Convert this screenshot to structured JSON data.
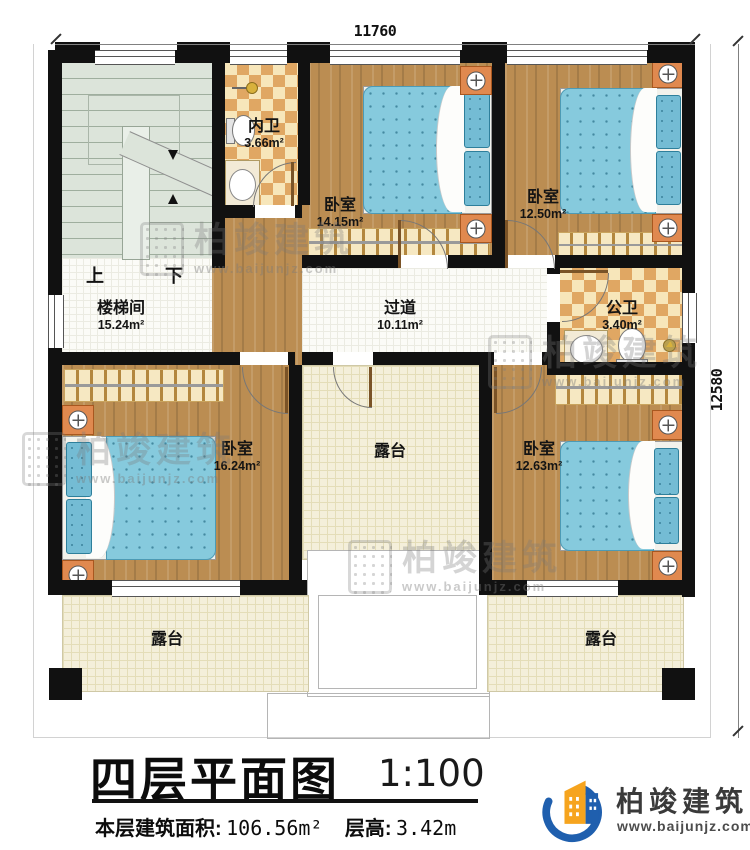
{
  "dimensions": {
    "top": "11760",
    "right": "12580"
  },
  "stairs": {
    "up": "上",
    "down": "下"
  },
  "rooms": [
    {
      "name": "楼梯间",
      "area": "15.24m²"
    },
    {
      "name": "内卫",
      "area": "3.66m²"
    },
    {
      "name": "卧室",
      "area": "14.15m²"
    },
    {
      "name": "卧室",
      "area": "12.50m²"
    },
    {
      "name": "过道",
      "area": "10.11m²"
    },
    {
      "name": "公卫",
      "area": "3.40m²"
    },
    {
      "name": "卧室",
      "area": "16.24m²"
    },
    {
      "name": "露台",
      "area": ""
    },
    {
      "name": "卧室",
      "area": "12.63m²"
    },
    {
      "name": "露台",
      "area": ""
    },
    {
      "name": "露台",
      "area": ""
    }
  ],
  "title": {
    "text": "四层平面图",
    "scale": "1:100"
  },
  "info": {
    "area_label": "本层建筑面积:",
    "area_value": "106.56m²",
    "height_label": "层高:",
    "height_value": "3.42m"
  },
  "logo": {
    "name": "柏竣建筑",
    "url": "www.baijunjz.com"
  },
  "watermark": {
    "name": "柏竣建筑",
    "url": "www.baijunjz.com"
  },
  "colors": {
    "wall": "#111111",
    "wood": "#bb8d52",
    "bed": "#86cadd",
    "pillow": "#74bcd4",
    "checker_dark": "#e0a763",
    "checker_light": "#f7e6ba",
    "terrace": "#f4efda",
    "stair": "#dce4da",
    "nightstand": "#e0894f",
    "wardrobe": "#f6e8c2",
    "logo_blue": "#1f5fae",
    "logo_orange": "#f6a41e"
  }
}
